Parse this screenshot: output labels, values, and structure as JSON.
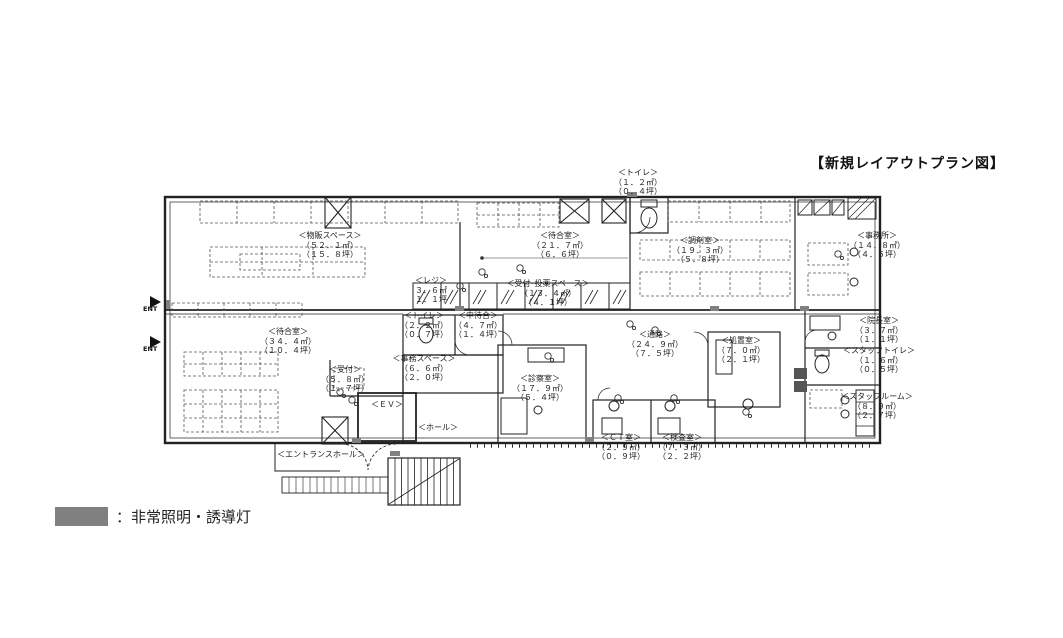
{
  "title": "【新規レイアウトプラン図】",
  "legend": {
    "label": "：非常照明・誘導灯",
    "swatch_color": "#808080"
  },
  "ent_label": "ENT",
  "rooms": [
    {
      "name": "＜物販スペース＞",
      "area": "（５２．１㎡）",
      "tsubo": "（１５．８坪）"
    },
    {
      "name": "＜トイレ＞",
      "area": "（１．２㎡）",
      "tsubo": "（０．４坪）"
    },
    {
      "name": "＜待合室＞",
      "area": "（２１．７㎡）",
      "tsubo": "（６．６坪）"
    },
    {
      "name": "＜調剤室＞",
      "area": "（１９．３㎡）",
      "tsubo": "（５．８坪）"
    },
    {
      "name": "＜事務所＞",
      "area": "（１４．８㎡）",
      "tsubo": "（４．５坪）"
    },
    {
      "name": "＜レジ＞",
      "area": "３．６㎡",
      "tsubo": "１．１坪"
    },
    {
      "name": "＜受付･投薬スペース＞",
      "area": "（１３．４㎡）",
      "tsubo": "（４．１坪）"
    },
    {
      "name": "＜トイレ＞",
      "area": "（２．２㎡）",
      "tsubo": "（０．７坪）"
    },
    {
      "name": "＜中待合＞",
      "area": "（４．７㎡）",
      "tsubo": "（１．４坪）"
    },
    {
      "name": "＜待合室＞",
      "area": "（３４．４㎡）",
      "tsubo": "（１０．４坪）"
    },
    {
      "name": "＜受付＞",
      "area": "（５．８㎡）",
      "tsubo": "（１．７坪）"
    },
    {
      "name": "＜事務スペース＞",
      "area": "（６．６㎡）",
      "tsubo": "（２．０坪）"
    },
    {
      "name": "＜診察室＞",
      "area": "（１７．９㎡）",
      "tsubo": "（５．４坪）"
    },
    {
      "name": "＜通路＞",
      "area": "（２４．９㎡）",
      "tsubo": "（７．５坪）"
    },
    {
      "name": "＜処置室＞",
      "area": "（７．０㎡）",
      "tsubo": "（２．１坪）"
    },
    {
      "name": "＜院長室＞",
      "area": "（３．７㎡）",
      "tsubo": "（１．１坪）"
    },
    {
      "name": "＜スタッフトイレ＞",
      "area": "（１．６㎡）",
      "tsubo": "（０．５坪）"
    },
    {
      "name": "＜スタッフルーム＞",
      "area": "（８．９㎡）",
      "tsubo": "（２．７坪）"
    },
    {
      "name": "＜ＣＴ室＞",
      "area": "（２．９㎡）",
      "tsubo": "（０．９坪）"
    },
    {
      "name": "＜検査室＞",
      "area": "（７．３㎡）",
      "tsubo": "（２．２坪）"
    },
    {
      "name": "＜ＥＶ＞"
    },
    {
      "name": "＜ホール＞"
    },
    {
      "name": "＜エントランスホール＞"
    }
  ]
}
